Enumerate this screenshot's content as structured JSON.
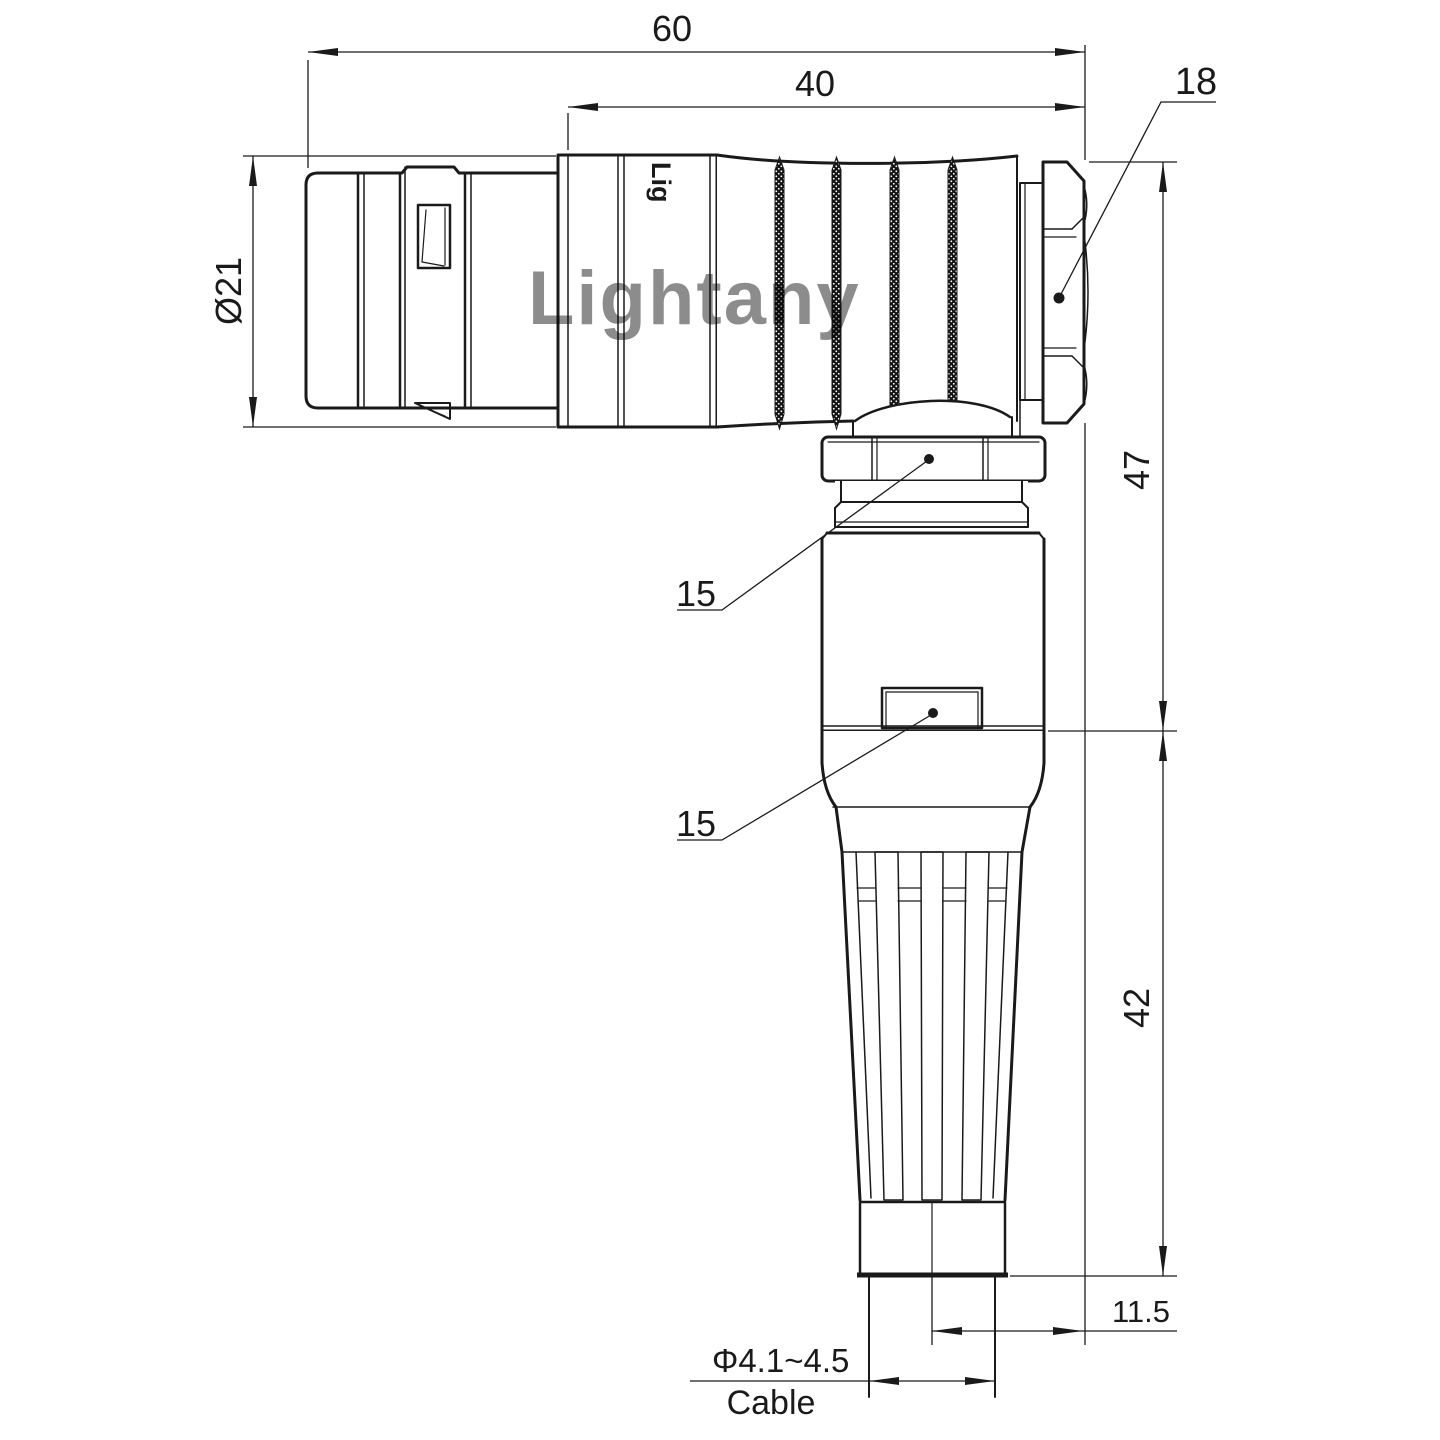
{
  "watermark": {
    "text": "Lightany",
    "color": "#eba9a9"
  },
  "brand_stamp": {
    "text": "Lig"
  },
  "dimensions": {
    "overall_length": "60",
    "rear_section_length": "40",
    "hex_nut_size": "18",
    "shell_diameter": "Ø21",
    "side_height": "47",
    "lower_height": "42",
    "axis_to_face_offset": "11.5",
    "coupling_nut_ref": "15",
    "latch_ref": "15",
    "cable_diameter_range": "Φ4.1~4.5",
    "cable_caption": "Cable"
  },
  "colors": {
    "line": "#1a1a1a",
    "background": "#ffffff",
    "watermark": "#eba9a9"
  }
}
